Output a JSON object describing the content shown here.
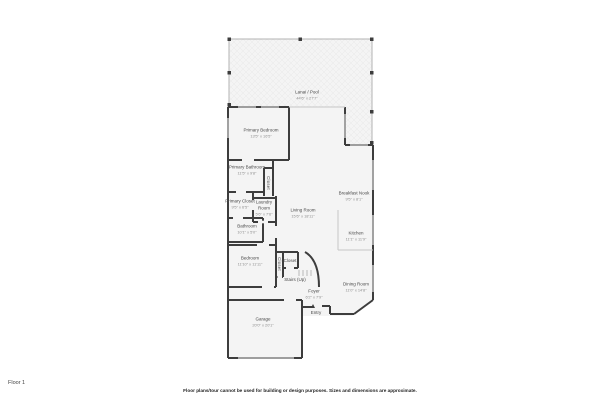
{
  "floor_label": "Floor 1",
  "disclaimer": "Floor plans/tour cannot be used for building or design purposes. Sizes and dimensions are approximate.",
  "colors": {
    "background": "#ffffff",
    "wall": "#3d3d3d",
    "room_fill": "#f4f4f4",
    "lanai_border": "#b3b3b3",
    "label_text": "#4a4a4a",
    "dims_text": "#8f8f8f"
  },
  "rooms": [
    {
      "name": "Lanai / Pool",
      "dims": "44'6\" x 27'7\""
    },
    {
      "name": "Primary Bedroom",
      "dims": "13'5\" x 16'5\""
    },
    {
      "name": "Primary Bathroom",
      "dims": "11'5\" x 9'8\""
    },
    {
      "name": "Closet",
      "dims": ""
    },
    {
      "name": "Primary Closet",
      "dims": "9'5\" x 6'5\""
    },
    {
      "name": "Laundry Room",
      "dims": "5'6\" x 7'6\""
    },
    {
      "name": "Bathroom",
      "dims": "10'1\" x 5'0\""
    },
    {
      "name": "Living Room",
      "dims": "15'6\" x 18'11\""
    },
    {
      "name": "Breakfast Nook",
      "dims": "9'5\" x 8'1\""
    },
    {
      "name": "Kitchen",
      "dims": "11'1\" x 11'9\""
    },
    {
      "name": "Bedroom",
      "dims": "11'10\" x 11'11\""
    },
    {
      "name": "Closet",
      "dims": ""
    },
    {
      "name": "Closet",
      "dims": ""
    },
    {
      "name": "Stairs (Up)",
      "dims": ""
    },
    {
      "name": "Dining Room",
      "dims": "11'0\" x 14'8\""
    },
    {
      "name": "Foyer",
      "dims": "6'2\" x 7'9\""
    },
    {
      "name": "Entry",
      "dims": ""
    },
    {
      "name": "Garage",
      "dims": "20'0\" x 20'1\""
    }
  ]
}
